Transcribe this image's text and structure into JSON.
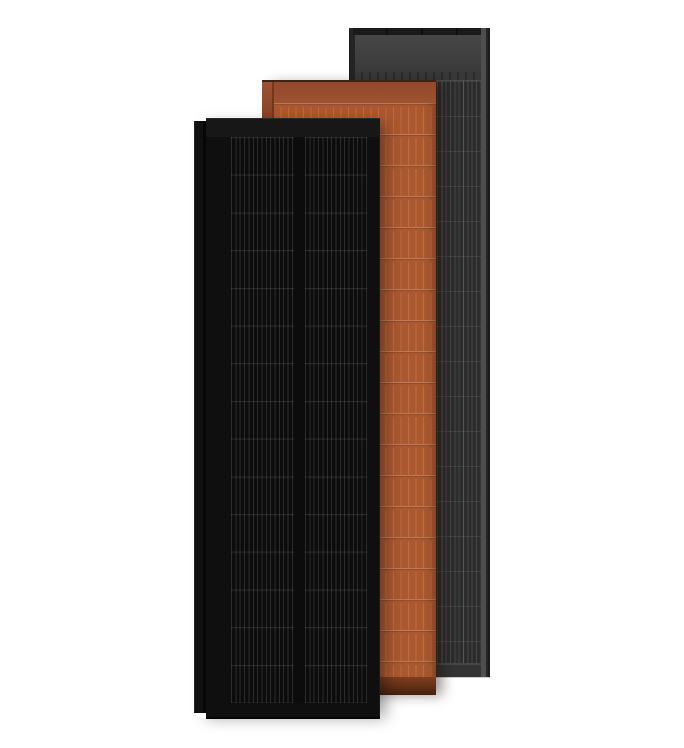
{
  "canvas": {
    "background_color": "#ffffff",
    "description": "Render of three upright rectangular solar panels overlapping left-to-front: black panel in front, terracotta panel in middle, dark anthracite-gray panel in back"
  },
  "panels": {
    "back_gray": {
      "name": "anthracite-gray-solar-panel",
      "stack_position": "back",
      "colors": {
        "--rail": "#242424",
        "--edge": "#1b1b1b",
        "--topcap": "#1a1a1a",
        "--topcap-div": "#0e0e0e",
        "--header-top": "#474747",
        "--header-bottom": "#3a3a3a",
        "--sep": "#2b2b2b",
        "--sep-line": "#4a4a4a",
        "--cell-bg": "#2c2c2c",
        "--line": "#454545",
        "--line-bright": "#565656",
        "--row": "rgba(255,255,255,0.08)",
        "--right-light": "#4e4e4e",
        "--bottom-top": "#474747",
        "--bottom": "#343434"
      }
    },
    "middle_terracotta": {
      "name": "terracotta-solar-panel",
      "stack_position": "middle",
      "colors": {
        "--topline": "#3f2416",
        "--header-top": "#93492a",
        "--header-bottom": "#9d5331",
        "--header-edge": "#7c3c1f",
        "--rail-top": "#9d5233",
        "--rail-mid": "#8a4527",
        "--rail-dark": "#502718",
        "--rail-line": "#6e3822",
        "--cell-bg": "#aa5830",
        "--line": "#c06b3f",
        "--row-light": "rgba(255,255,255,0.20)",
        "--row-dark": "rgba(0,0,0,0.12)",
        "--bottom-top": "#7d3d20",
        "--bottom-mid": "#6b3319",
        "--bottom-dark": "#44210e"
      }
    },
    "front_black": {
      "name": "full-black-solar-panel",
      "stack_position": "front",
      "colors": {
        "--rail-edge": "#232323",
        "--rail": "#101010",
        "--rail-gap": "#060606",
        "--body": "#0f0f0f",
        "--body-top-edge": "#2a2a2a",
        "--band": "#171717",
        "--cell-bg": "#0c0c0c",
        "--line": "#2c2c2c",
        "--row": "rgba(255,255,255,0.10)",
        "--bottom-edge": "#040404"
      }
    }
  }
}
